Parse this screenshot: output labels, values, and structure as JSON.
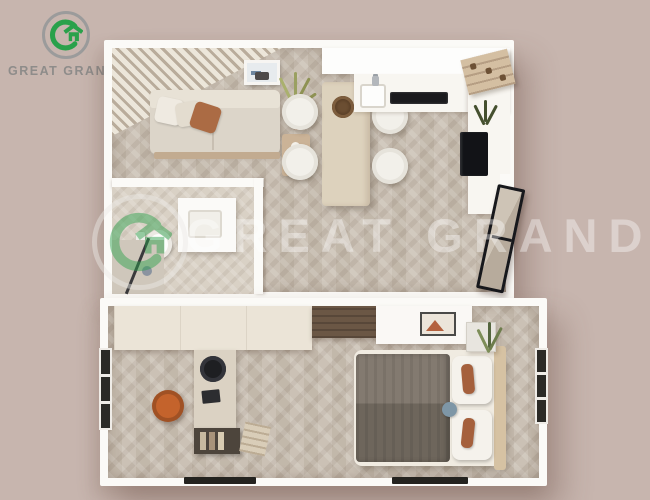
{
  "brand": {
    "name": "GREAT GRANDE"
  },
  "watermark": {
    "text": "GREAT GRANDE"
  },
  "palette": {
    "background": "#c7b5ae",
    "logo_green": "#2aa14b",
    "logo_ring": "#9b9b9b",
    "brand_text": "#8e8c8a",
    "wall": "#fbfaf7",
    "terracotta": "#ab6b44"
  },
  "floorplan": {
    "view": "3d-top-down-render",
    "modules": [
      {
        "name": "living-kitchen-module",
        "rooms": [
          {
            "name": "living-room",
            "furniture": [
              "slat-accent-wall",
              "sofa",
              "white-throw-pillows",
              "terracotta-pillow",
              "side-table",
              "wall-art",
              "potted-plant"
            ]
          },
          {
            "name": "dining-area",
            "furniture": [
              "wood-dining-table",
              "woven-basket-centerpiece",
              "white-chair",
              "white-chair",
              "white-chair",
              "white-chair"
            ]
          },
          {
            "name": "kitchen",
            "furniture": [
              "upper-cabinets",
              "counter",
              "sink",
              "faucet",
              "cooktop",
              "open-shelf",
              "refrigerator",
              "plant"
            ]
          },
          {
            "name": "bathroom",
            "furniture": [
              "vanity-sink",
              "toilet",
              "shower"
            ]
          },
          {
            "name": "entry",
            "furniture": [
              "black-frame-glass-door"
            ]
          }
        ]
      },
      {
        "name": "bedroom-office-module",
        "rooms": [
          {
            "name": "office",
            "furniture": [
              "wardrobe",
              "desk",
              "black-stool",
              "laptop",
              "bookshelf",
              "magazine-stack",
              "orange-chair",
              "window"
            ]
          },
          {
            "name": "bedroom",
            "furniture": [
              "dark-wood-partition",
              "white-dresser",
              "wall-art",
              "double-bed",
              "gray-blanket",
              "white-pillows",
              "terracotta-lumbar-pillows",
              "round-blue-pillow",
              "headboard",
              "nightstand",
              "plant",
              "window"
            ]
          }
        ]
      }
    ]
  }
}
